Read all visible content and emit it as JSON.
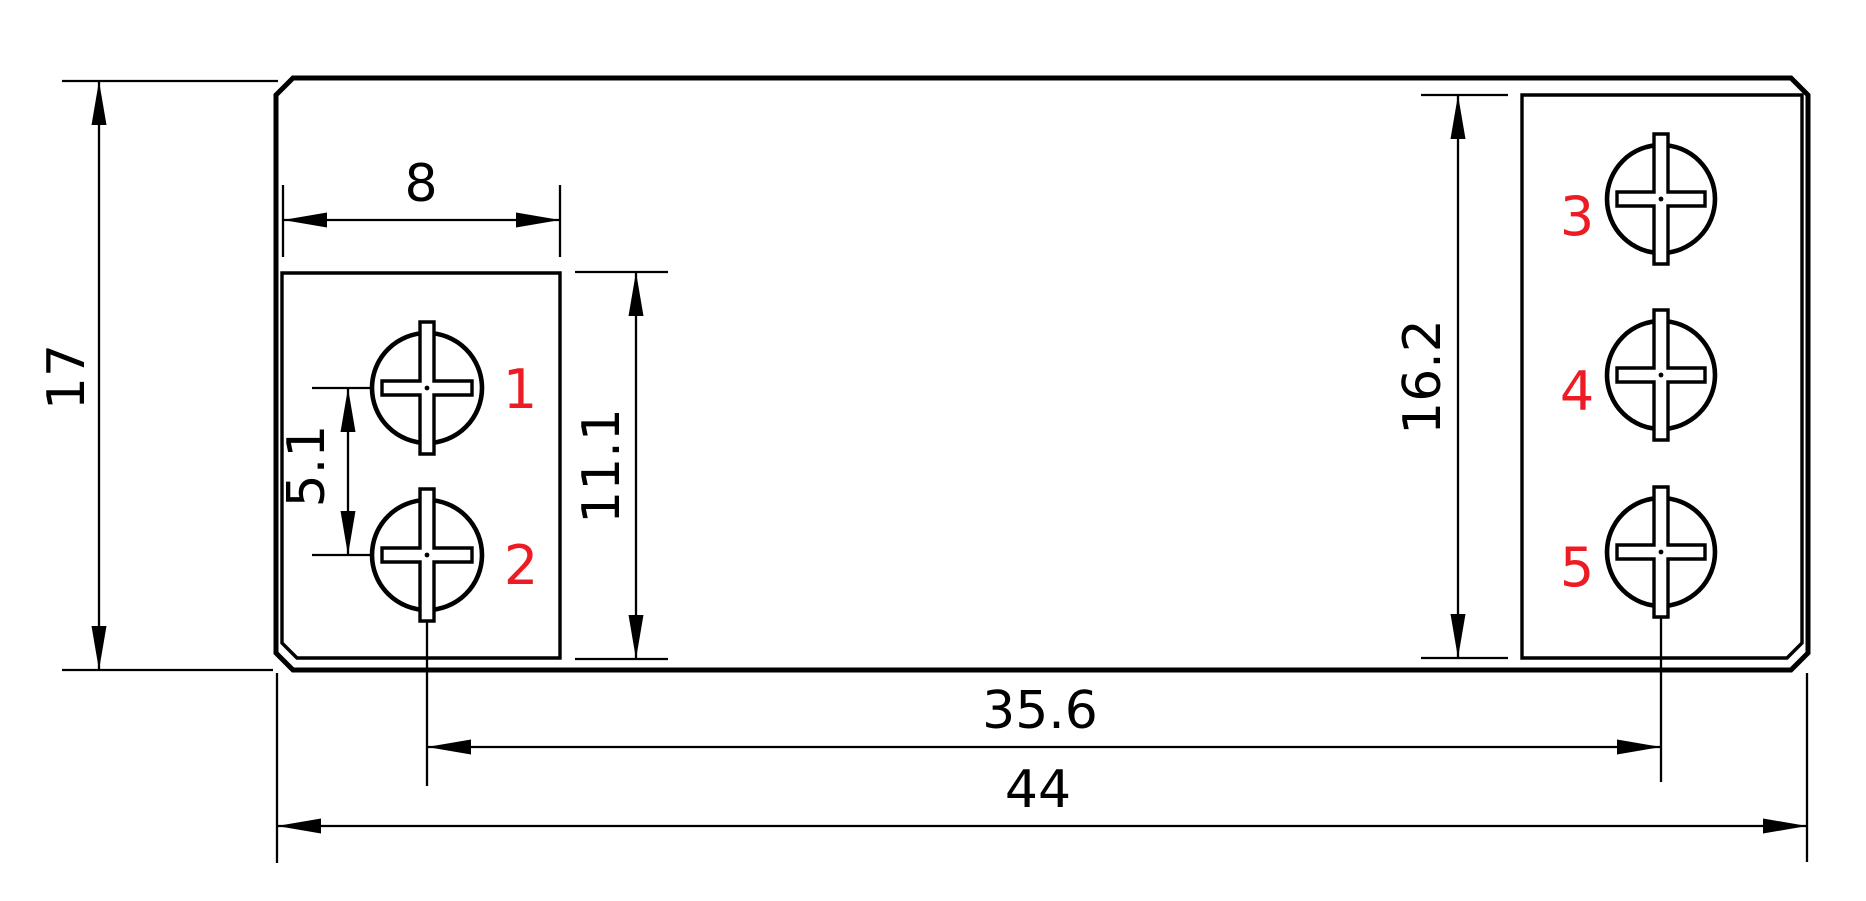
{
  "drawing": {
    "type": "engineering-dimension-drawing",
    "background": "#ffffff",
    "line_color": "#000000",
    "label_color": "#ed1c24",
    "dimensions": {
      "overall_height": "17",
      "block_width": "8",
      "screw_pitch": "5.1",
      "left_block_height": "11.1",
      "right_block_height": "16.2",
      "screw_span": "35.6",
      "overall_width": "44"
    },
    "terminals": [
      "1",
      "2",
      "3",
      "4",
      "5"
    ]
  }
}
